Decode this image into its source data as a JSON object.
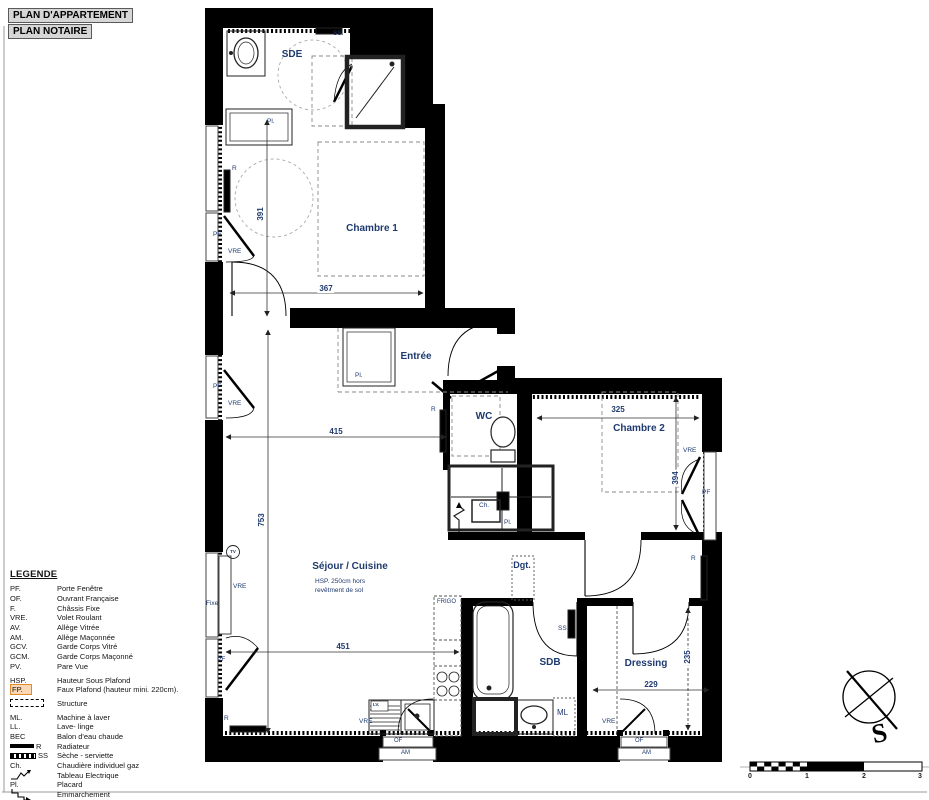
{
  "page": {
    "title1": "PLAN D'APPARTEMENT",
    "title2": "PLAN NOTAIRE"
  },
  "legend": {
    "title": "LEGENDE",
    "items": [
      {
        "abbr": "PF.",
        "label": "Porte Fenêtre"
      },
      {
        "abbr": "OF.",
        "label": "Ouvrant Française"
      },
      {
        "abbr": "F.",
        "label": "Châssis Fixe"
      },
      {
        "abbr": "VRE.",
        "label": "Volet Roulant"
      },
      {
        "abbr": "AV.",
        "label": "Allège Vitrée"
      },
      {
        "abbr": "AM.",
        "label": "Allège Maçonnée"
      },
      {
        "abbr": "GCV.",
        "label": "Garde Corps Vitré"
      },
      {
        "abbr": "GCM.",
        "label": "Garde Corps Maçonné"
      },
      {
        "abbr": "PV.",
        "label": "Pare Vue"
      },
      {
        "abbr": "HSP.",
        "label": "Hauteur Sous Plafond"
      },
      {
        "abbr": "FP.",
        "label": "Faux Plafond (hauteur mini. 220cm)."
      },
      {
        "abbr": "",
        "label": "Structure"
      },
      {
        "abbr": "ML.",
        "label": "Machine à laver"
      },
      {
        "abbr": "LL.",
        "label": "Lave- linge"
      },
      {
        "abbr": "BEC",
        "label": "Balon d'eau chaude"
      },
      {
        "abbr": "R",
        "label": "Radiateur"
      },
      {
        "abbr": "SS",
        "label": "Sèche - serviette"
      },
      {
        "abbr": "Ch.",
        "label": "Chaudière individuel gaz"
      },
      {
        "abbr": "",
        "label": "Tableau Electrique"
      },
      {
        "abbr": "Pl.",
        "label": "Placard"
      },
      {
        "abbr": "",
        "label": "Emmarchement"
      }
    ]
  },
  "rooms": {
    "sde": "SDE",
    "chambre1": "Chambre 1",
    "entree": "Entrée",
    "wc": "WC",
    "chambre2": "Chambre 2",
    "sejour": "Séjour / Cuisine",
    "dgt": "Dgt.",
    "sdb": "SDB",
    "dressing": "Dressing"
  },
  "notes": {
    "hsp1": "HSP. 250cm hors",
    "hsp2": "revêtment de sol"
  },
  "dims": {
    "chambre1_h": "391",
    "chambre1_w": "367",
    "sejour_w1": "415",
    "sejour_h": "753",
    "sejour_w2": "451",
    "chambre2_w": "325",
    "chambre2_h": "394",
    "dressing_w": "229",
    "dressing_h": "235"
  },
  "tags": {
    "pf": "PF",
    "vre": "VRE",
    "fixe": "Fixe",
    "r": "R",
    "ss_dot": "SS.",
    "ss": "SS",
    "ch": "Ch.",
    "pl": "Pl.",
    "ml": "ML",
    "lv": "LV.",
    "frigo": "FRIGO",
    "tv": "TV",
    "of": "OF",
    "am": "AM"
  },
  "compass": {
    "south": "S"
  },
  "scalebar": {
    "t0": "0",
    "t1": "1",
    "t2": "2",
    "t3": "3"
  },
  "colors": {
    "label_navy": "#1e3a6e",
    "wall": "#000000",
    "fp_highlight_bg": "#fcd7b3",
    "fp_highlight_border": "#e0892f"
  }
}
